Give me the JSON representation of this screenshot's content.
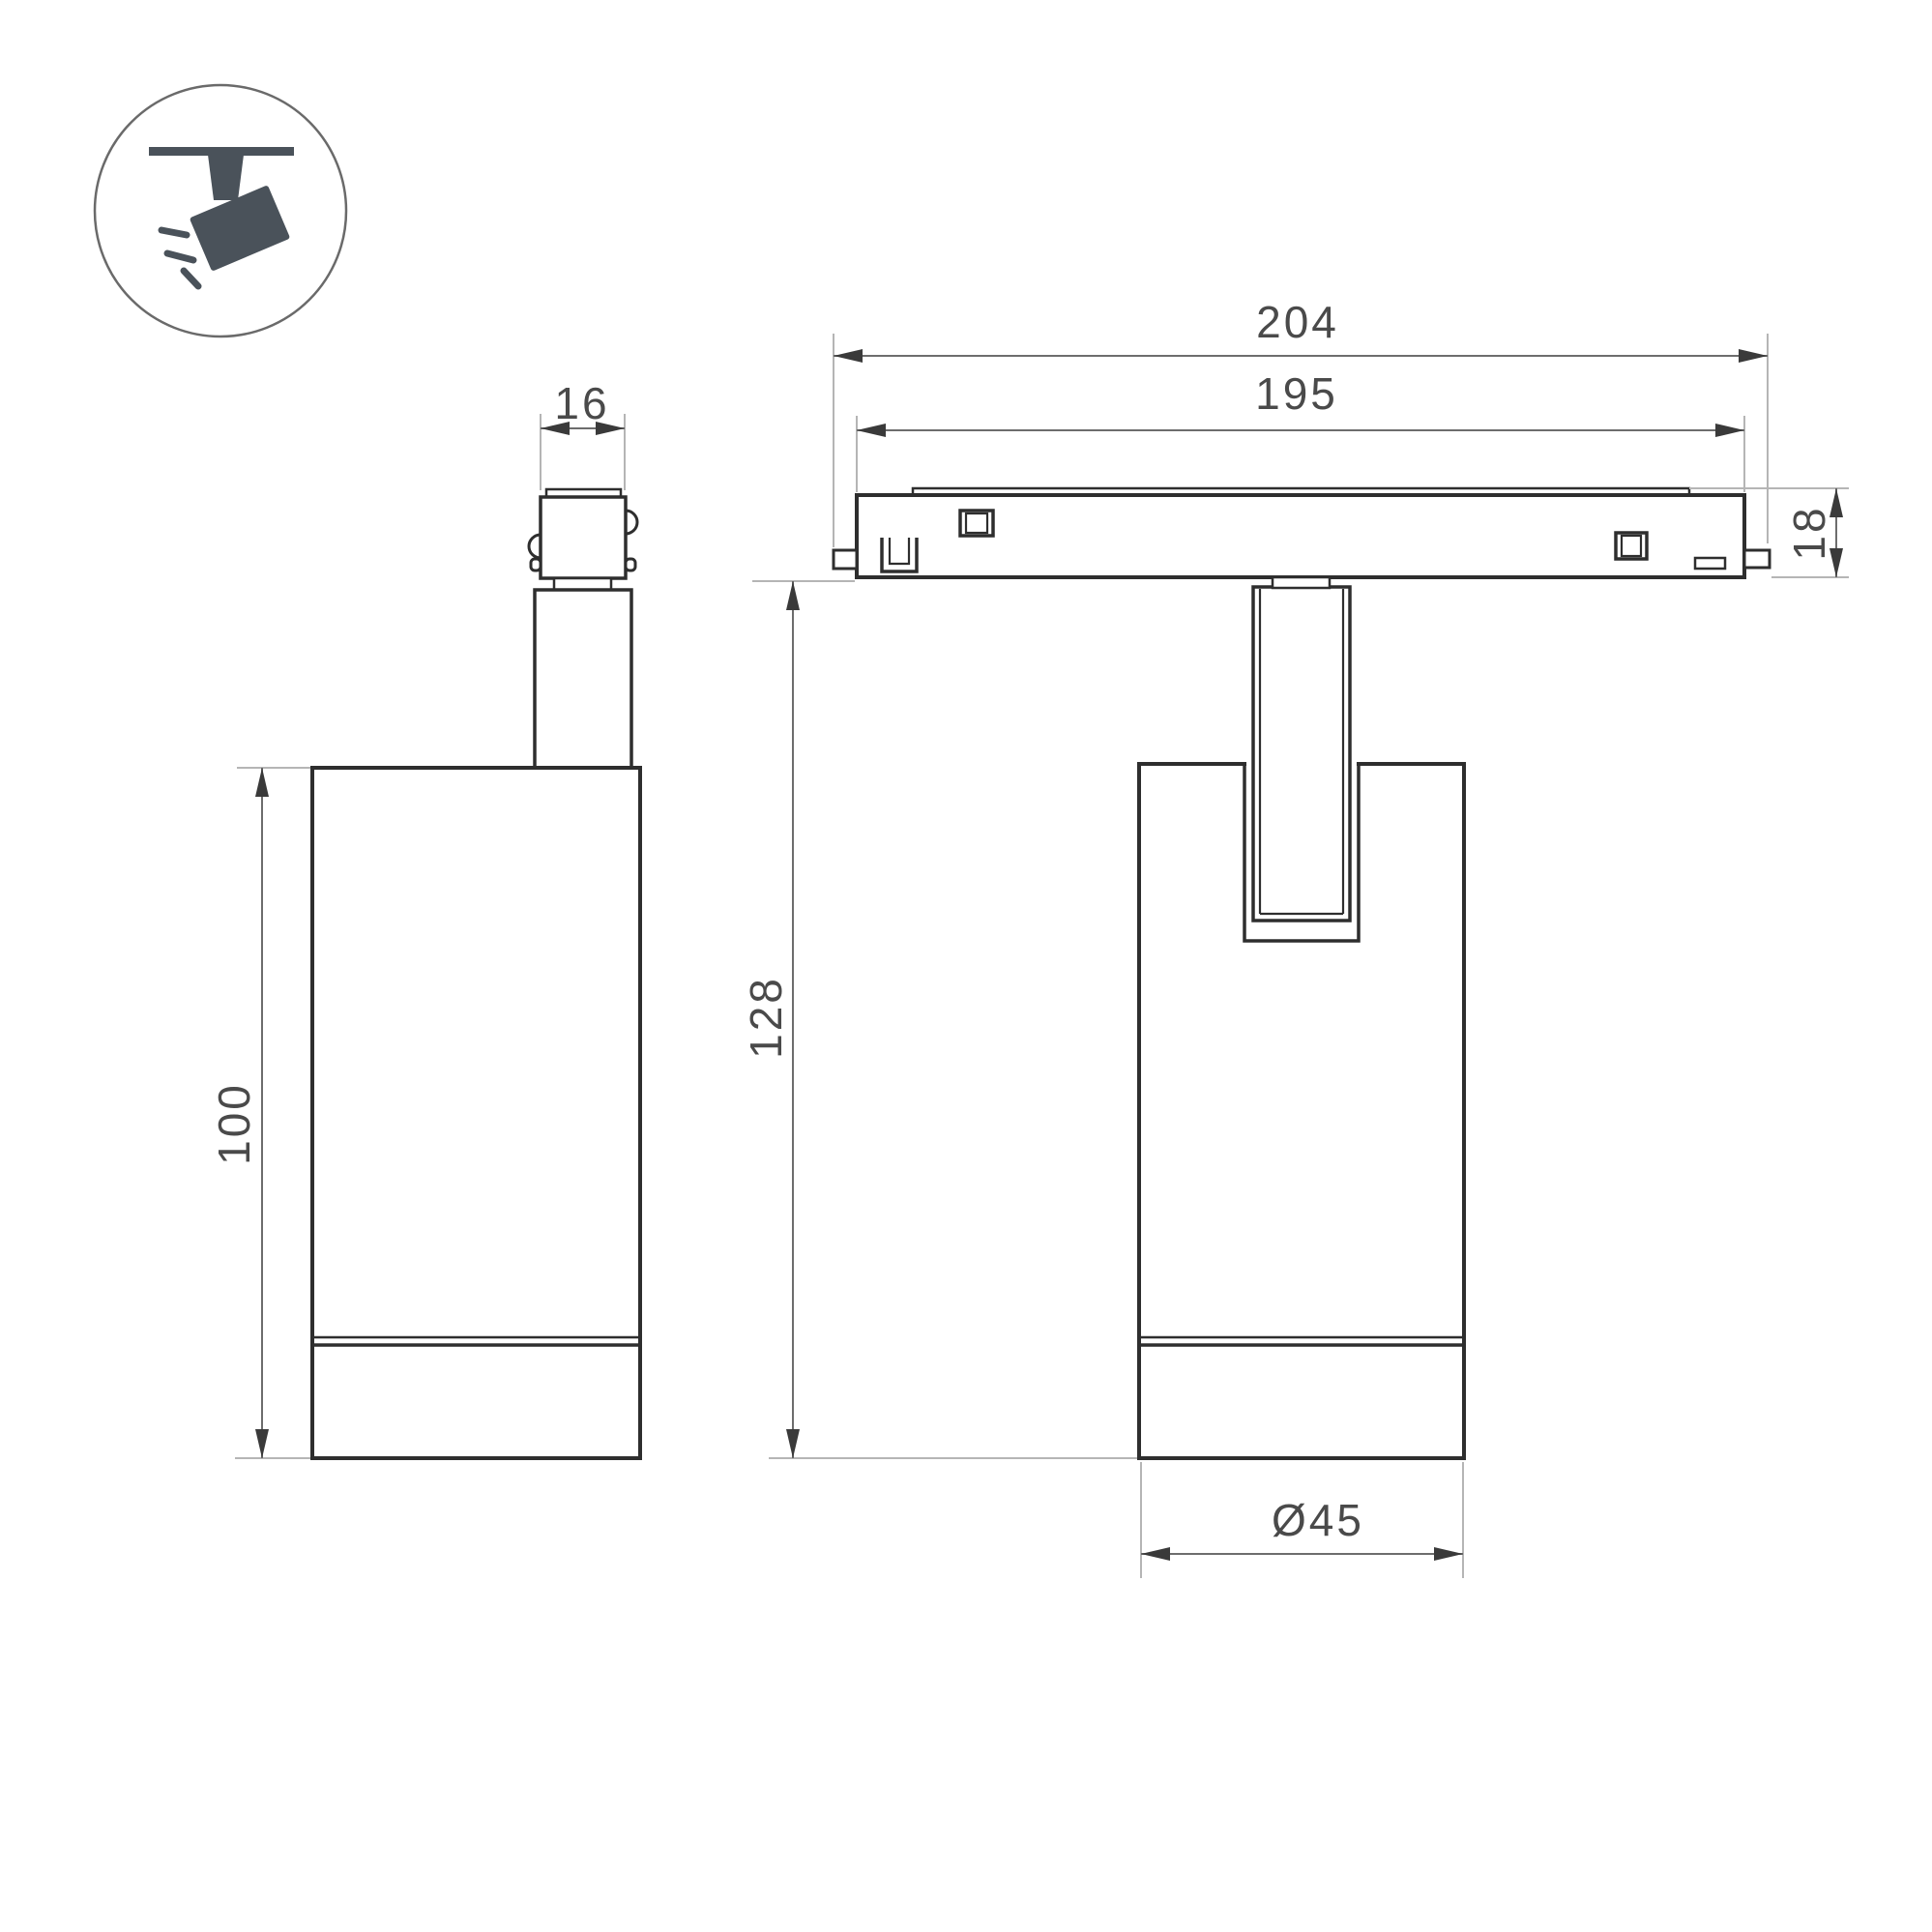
{
  "title": "Track spotlight dimension drawing",
  "icon": {
    "name": "track-spotlight-icon"
  },
  "dimensions": {
    "connector_width": "16",
    "body_height": "100",
    "track_length": "204",
    "track_inner_length": "195",
    "track_height": "18",
    "total_height": "128",
    "body_diameter": "Ø45"
  },
  "colors": {
    "outline": "#2e2e2e",
    "dimension_line": "#6d6d6d",
    "extension_line": "#b5b5b5",
    "label_text": "#4a4a4a",
    "icon_fill": "#4a525a",
    "background": "#ffffff"
  }
}
